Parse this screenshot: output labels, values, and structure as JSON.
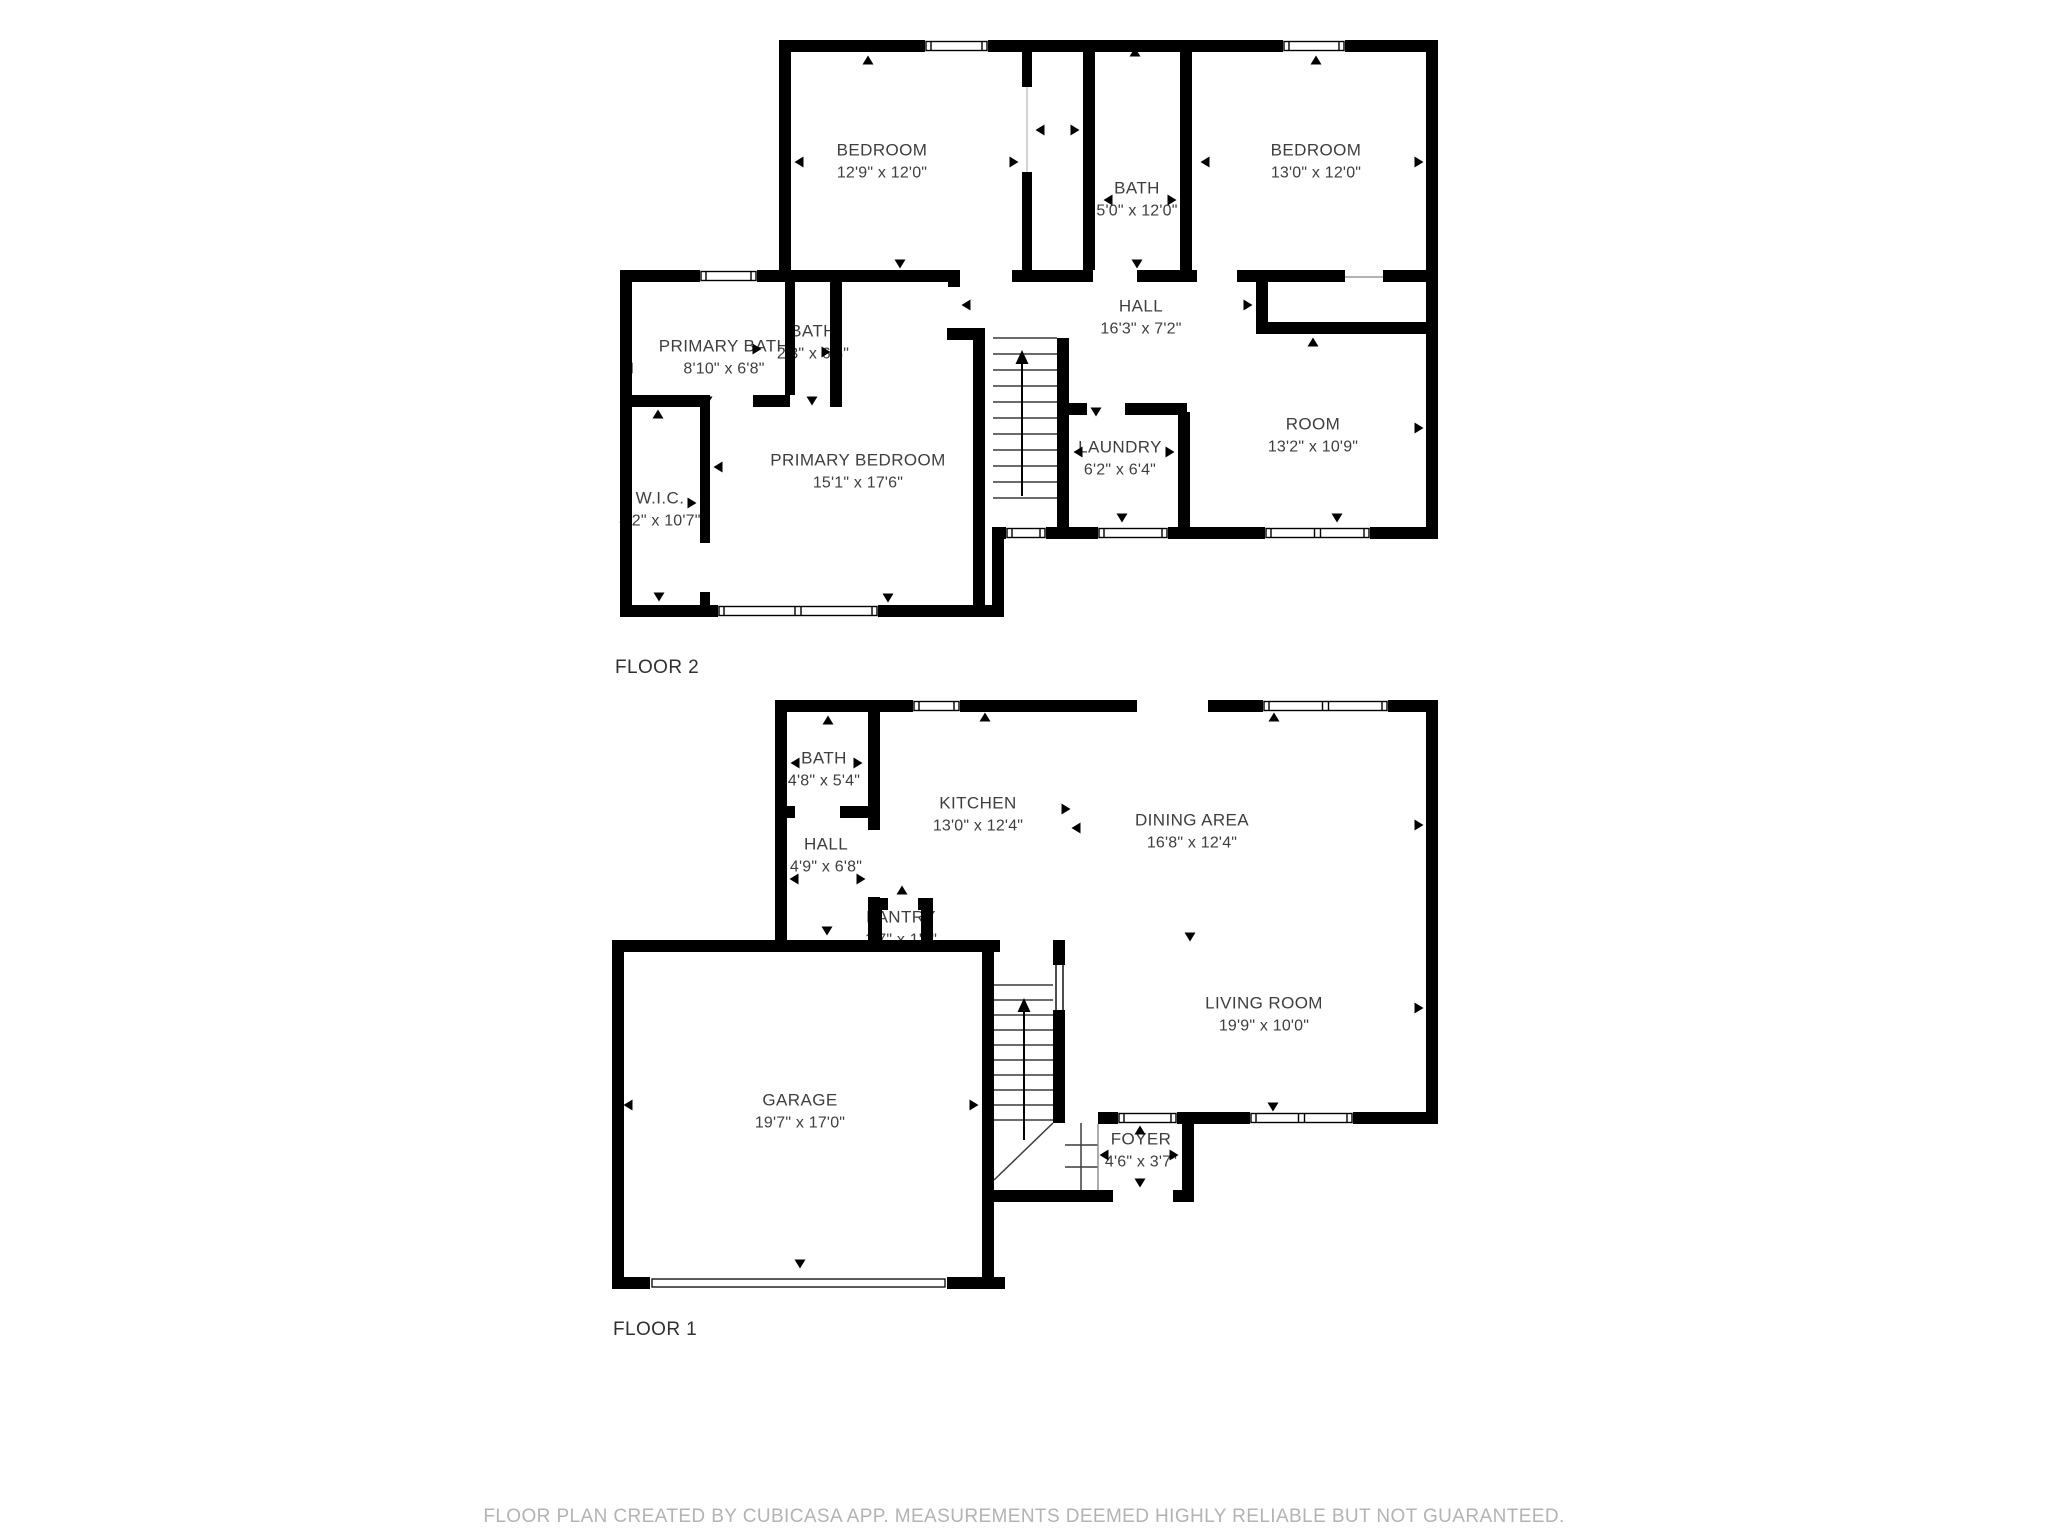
{
  "colors": {
    "wall": "#000000",
    "label_text": "#3e3e3e",
    "footer_text": "#b3b3b3"
  },
  "floor2": {
    "label": "FLOOR 2",
    "rooms": [
      {
        "id": "bedroom-1",
        "name": "BEDROOM",
        "dims": "12'9\" x 12'0\""
      },
      {
        "id": "bath",
        "name": "BATH",
        "dims": "5'0\" x 12'0\""
      },
      {
        "id": "bedroom-2",
        "name": "BEDROOM",
        "dims": "13'0\" x 12'0\""
      },
      {
        "id": "hall",
        "name": "HALL",
        "dims": "16'3\" x 7'2\""
      },
      {
        "id": "primary-bath",
        "name": "PRIMARY BATH",
        "dims": "8'10\" x 6'8\""
      },
      {
        "id": "bath-2",
        "name": "BATH",
        "dims": "2'3\" x 6'8\""
      },
      {
        "id": "primary-bedroom",
        "name": "PRIMARY BEDROOM",
        "dims": "15'1\" x 17'6\""
      },
      {
        "id": "wic",
        "name": "W.I.C.",
        "dims": "4'2\" x 10'7\""
      },
      {
        "id": "laundry",
        "name": "LAUNDRY",
        "dims": "6'2\" x 6'4\""
      },
      {
        "id": "room",
        "name": "ROOM",
        "dims": "13'2\" x 10'9\""
      }
    ]
  },
  "floor1": {
    "label": "FLOOR 1",
    "rooms": [
      {
        "id": "bath",
        "name": "BATH",
        "dims": "4'8\" x 5'4\""
      },
      {
        "id": "hall",
        "name": "HALL",
        "dims": "4'9\" x 6'8\""
      },
      {
        "id": "pantry",
        "name": "PANTRY",
        "dims": "1'7\" x 1'8\""
      },
      {
        "id": "kitchen",
        "name": "KITCHEN",
        "dims": "13'0\" x 12'4\""
      },
      {
        "id": "dining-area",
        "name": "DINING AREA",
        "dims": "16'8\" x 12'4\""
      },
      {
        "id": "living-room",
        "name": "LIVING ROOM",
        "dims": "19'9\" x 10'0\""
      },
      {
        "id": "garage",
        "name": "GARAGE",
        "dims": "19'7\" x 17'0\""
      },
      {
        "id": "foyer",
        "name": "FOYER",
        "dims": "4'6\" x 3'7\""
      }
    ]
  },
  "footer": {
    "text": "FLOOR PLAN CREATED BY CUBICASA APP. MEASUREMENTS DEEMED HIGHLY RELIABLE BUT NOT GUARANTEED."
  }
}
